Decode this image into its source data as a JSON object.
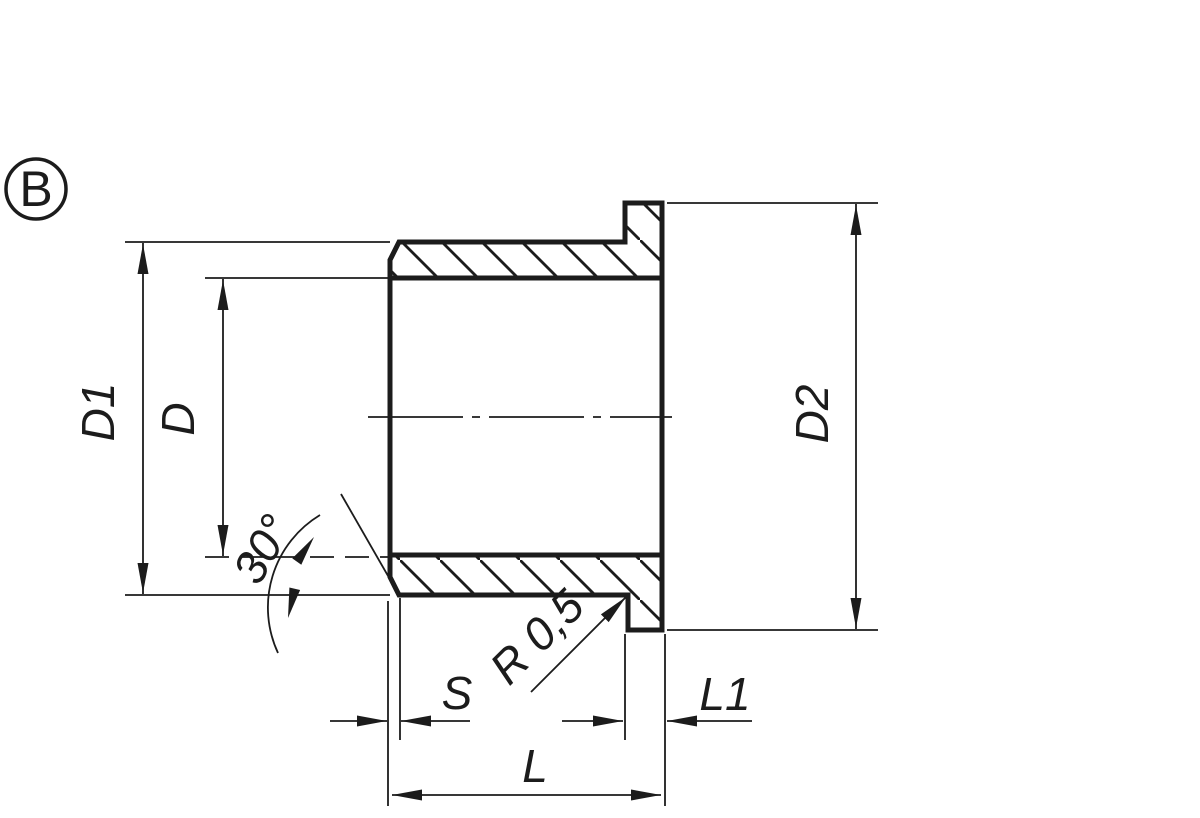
{
  "colors": {
    "line": "#1c1c1c",
    "background": "#ffffff"
  },
  "view": {
    "label": "B"
  },
  "labels": {
    "outer_diameter_body": "D1",
    "bore_diameter": "D",
    "flange_diameter": "D2",
    "chamfer_angle": "30°",
    "fillet_radius": "R 0,5",
    "chamfer_length": "S",
    "flange_thickness": "L1",
    "total_length": "L"
  }
}
